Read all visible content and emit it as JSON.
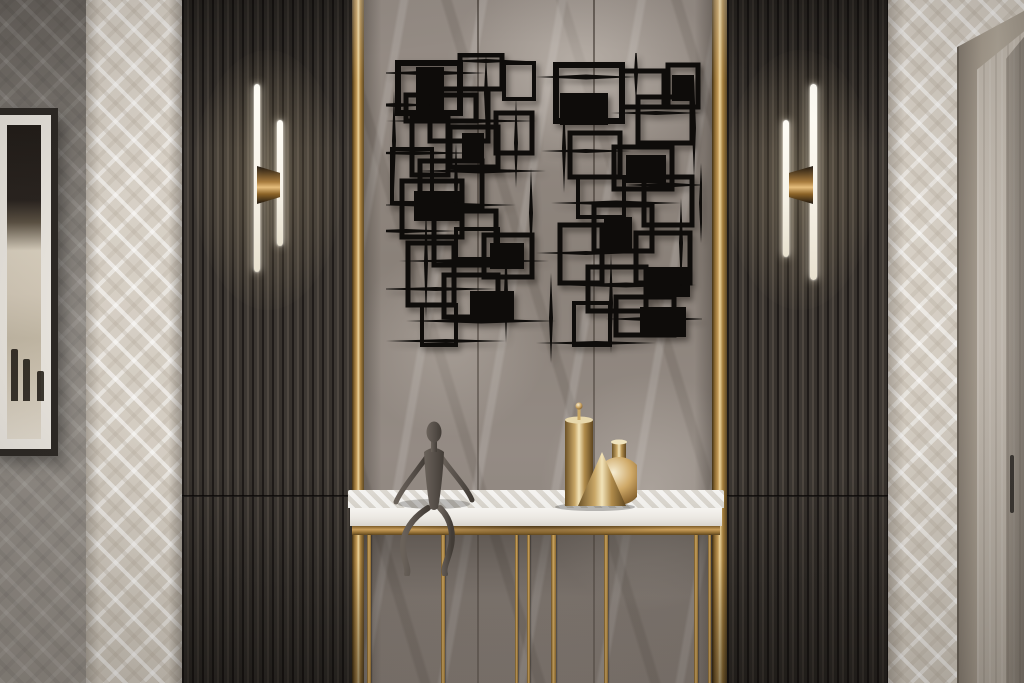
{
  "palette": {
    "art_black": "#0e0c0a",
    "slat_face": "#3d3833",
    "slat_groove": "#1f1b19",
    "slat_hi": "#4e4740",
    "gold_light": "#ecd49c",
    "gold_mid": "#c29a58",
    "gold_dark": "#5e4824",
    "marble_base": "#8d847d",
    "marble_light": "#a29993",
    "marble_dark": "#6f675f",
    "wp_base": "#d6cfc5",
    "wall_grey": "#8f8a84",
    "wall_grey_dark": "#6c6762",
    "frame_dark": "#2d2925",
    "mat_white": "#eae6df",
    "table_white": "#edebe6",
    "apron_gold": "#9c7839",
    "fig_bronze": "#57504a",
    "sconce_white": "#f8f4ea",
    "door_frame": "#aca294",
    "door_panel": "#c2bab0",
    "handle_dark": "#3b3733"
  },
  "scene": {
    "marble": {
      "seams_x": [
        477,
        593
      ]
    },
    "wall_art": {
      "canvas": {
        "x": 386,
        "y": 53,
        "w": 316,
        "h": 320
      },
      "clusters": [
        {
          "rects": [
            [
              12,
              10,
              62,
              50,
              6
            ],
            [
              30,
              14,
              28,
              44,
              0
            ],
            [
              20,
              42,
              70,
              26,
              5
            ],
            [
              44,
              36,
              58,
              52,
              5
            ],
            [
              74,
              2,
              42,
              34,
              5
            ],
            [
              26,
              64,
              36,
              58,
              5
            ],
            [
              64,
              74,
              48,
              40,
              5
            ],
            [
              76,
              80,
              22,
              28,
              0
            ],
            [
              6,
              96,
              40,
              54,
              4
            ],
            [
              34,
              108,
              62,
              46,
              5
            ],
            [
              16,
              128,
              60,
              56,
              5
            ],
            [
              28,
              138,
              46,
              30,
              0
            ],
            [
              48,
              158,
              62,
              54,
              5
            ],
            [
              70,
              176,
              42,
              30,
              4
            ],
            [
              98,
              182,
              48,
              42,
              5
            ],
            [
              104,
              190,
              34,
              26,
              0
            ],
            [
              22,
              190,
              46,
              62,
              5
            ],
            [
              58,
              222,
              54,
              42,
              5
            ],
            [
              84,
              238,
              44,
              30,
              0
            ],
            [
              36,
              252,
              34,
              40,
              4
            ],
            [
              110,
              60,
              36,
              40,
              5
            ],
            [
              118,
              10,
              30,
              36,
              4
            ]
          ],
          "spikes": [
            [
              45,
              20,
              110,
              5
            ],
            [
              100,
              8,
              80,
              4
            ],
            [
              10,
              52,
              90,
              4
            ],
            [
              75,
              68,
              150,
              5
            ],
            [
              28,
              100,
              120,
              4
            ],
            [
              95,
              118,
              130,
              5
            ],
            [
              60,
              152,
              140,
              5
            ],
            [
              20,
              178,
              100,
              4
            ],
            [
              88,
              208,
              150,
              5
            ],
            [
              50,
              236,
              120,
              4
            ],
            [
              95,
              268,
              150,
              5
            ],
            [
              60,
              288,
              120,
              4
            ],
            [
              8,
              88,
              100,
              4,
              1
            ],
            [
              100,
              40,
              80,
              4,
              1
            ],
            [
              130,
              90,
              90,
              4,
              1
            ],
            [
              40,
              210,
              110,
              4,
              1
            ],
            [
              120,
              240,
              100,
              4,
              1
            ],
            [
              70,
              130,
              80,
              4,
              1
            ],
            [
              145,
              160,
              90,
              4,
              1
            ]
          ]
        },
        {
          "rects": [
            [
              170,
              12,
              66,
              56,
              6
            ],
            [
              174,
              40,
              48,
              32,
              0
            ],
            [
              236,
              18,
              42,
              36,
              5
            ],
            [
              282,
              12,
              30,
              42,
              5
            ],
            [
              286,
              22,
              22,
              26,
              0
            ],
            [
              252,
              44,
              54,
              46,
              5
            ],
            [
              184,
              80,
              50,
              44,
              5
            ],
            [
              228,
              94,
              58,
              42,
              5
            ],
            [
              240,
              102,
              40,
              28,
              0
            ],
            [
              258,
              124,
              48,
              48,
              5
            ],
            [
              192,
              124,
              46,
              40,
              4
            ],
            [
              208,
              152,
              58,
              46,
              5
            ],
            [
              174,
              172,
              42,
              58,
              5
            ],
            [
              218,
              164,
              28,
              34,
              0
            ],
            [
              250,
              180,
              54,
              50,
              5
            ],
            [
              262,
              214,
              42,
              30,
              0
            ],
            [
              202,
              214,
              58,
              44,
              5
            ],
            [
              230,
              244,
              58,
              38,
              5
            ],
            [
              188,
              250,
              36,
              42,
              4
            ],
            [
              254,
              254,
              46,
              30,
              0
            ]
          ],
          "spikes": [
            [
              200,
              24,
              100,
              5
            ],
            [
              270,
              60,
              90,
              4
            ],
            [
              200,
              98,
              90,
              4
            ],
            [
              280,
              132,
              80,
              5
            ],
            [
              230,
              150,
              130,
              5
            ],
            [
              200,
              200,
              100,
              4
            ],
            [
              240,
              232,
              140,
              5
            ],
            [
              270,
              266,
              100,
              5
            ],
            [
              210,
              290,
              120,
              4
            ],
            [
              178,
              95,
              90,
              4,
              1
            ],
            [
              308,
              75,
              100,
              4,
              1
            ],
            [
              225,
              250,
              100,
              4,
              1
            ],
            [
              295,
              190,
              90,
              4,
              1
            ],
            [
              165,
              265,
              90,
              4,
              1
            ],
            [
              250,
              20,
              60,
              4,
              1
            ],
            [
              315,
              150,
              80,
              4,
              1
            ]
          ]
        }
      ]
    },
    "sconces": [
      {
        "side": "left",
        "bars": [
          {
            "x": 254,
            "y": 84,
            "w": 6,
            "h": 188
          },
          {
            "x": 277,
            "y": 120,
            "w": 6,
            "h": 126
          }
        ],
        "bracket": {
          "x": 257,
          "y": 166,
          "w": 23,
          "h": 38,
          "dir": "left"
        },
        "glow": {
          "cx": 268,
          "cy": 180
        }
      },
      {
        "side": "right",
        "bars": [
          {
            "x": 783,
            "y": 120,
            "w": 6,
            "h": 137
          },
          {
            "x": 810,
            "y": 84,
            "w": 7,
            "h": 196
          }
        ],
        "bracket": {
          "x": 789,
          "y": 166,
          "w": 24,
          "h": 38,
          "dir": "right"
        },
        "glow": {
          "cx": 800,
          "cy": 180
        }
      }
    ],
    "console_table": {
      "legs_y_top": 535,
      "legs": [
        {
          "x": 367,
          "w": 4
        },
        {
          "x": 441,
          "w": 4
        },
        {
          "x": 515,
          "w": 3
        },
        {
          "x": 527,
          "w": 3
        },
        {
          "x": 551,
          "w": 5
        },
        {
          "x": 604,
          "w": 4
        },
        {
          "x": 694,
          "w": 4
        },
        {
          "x": 708,
          "w": 3
        }
      ]
    }
  }
}
